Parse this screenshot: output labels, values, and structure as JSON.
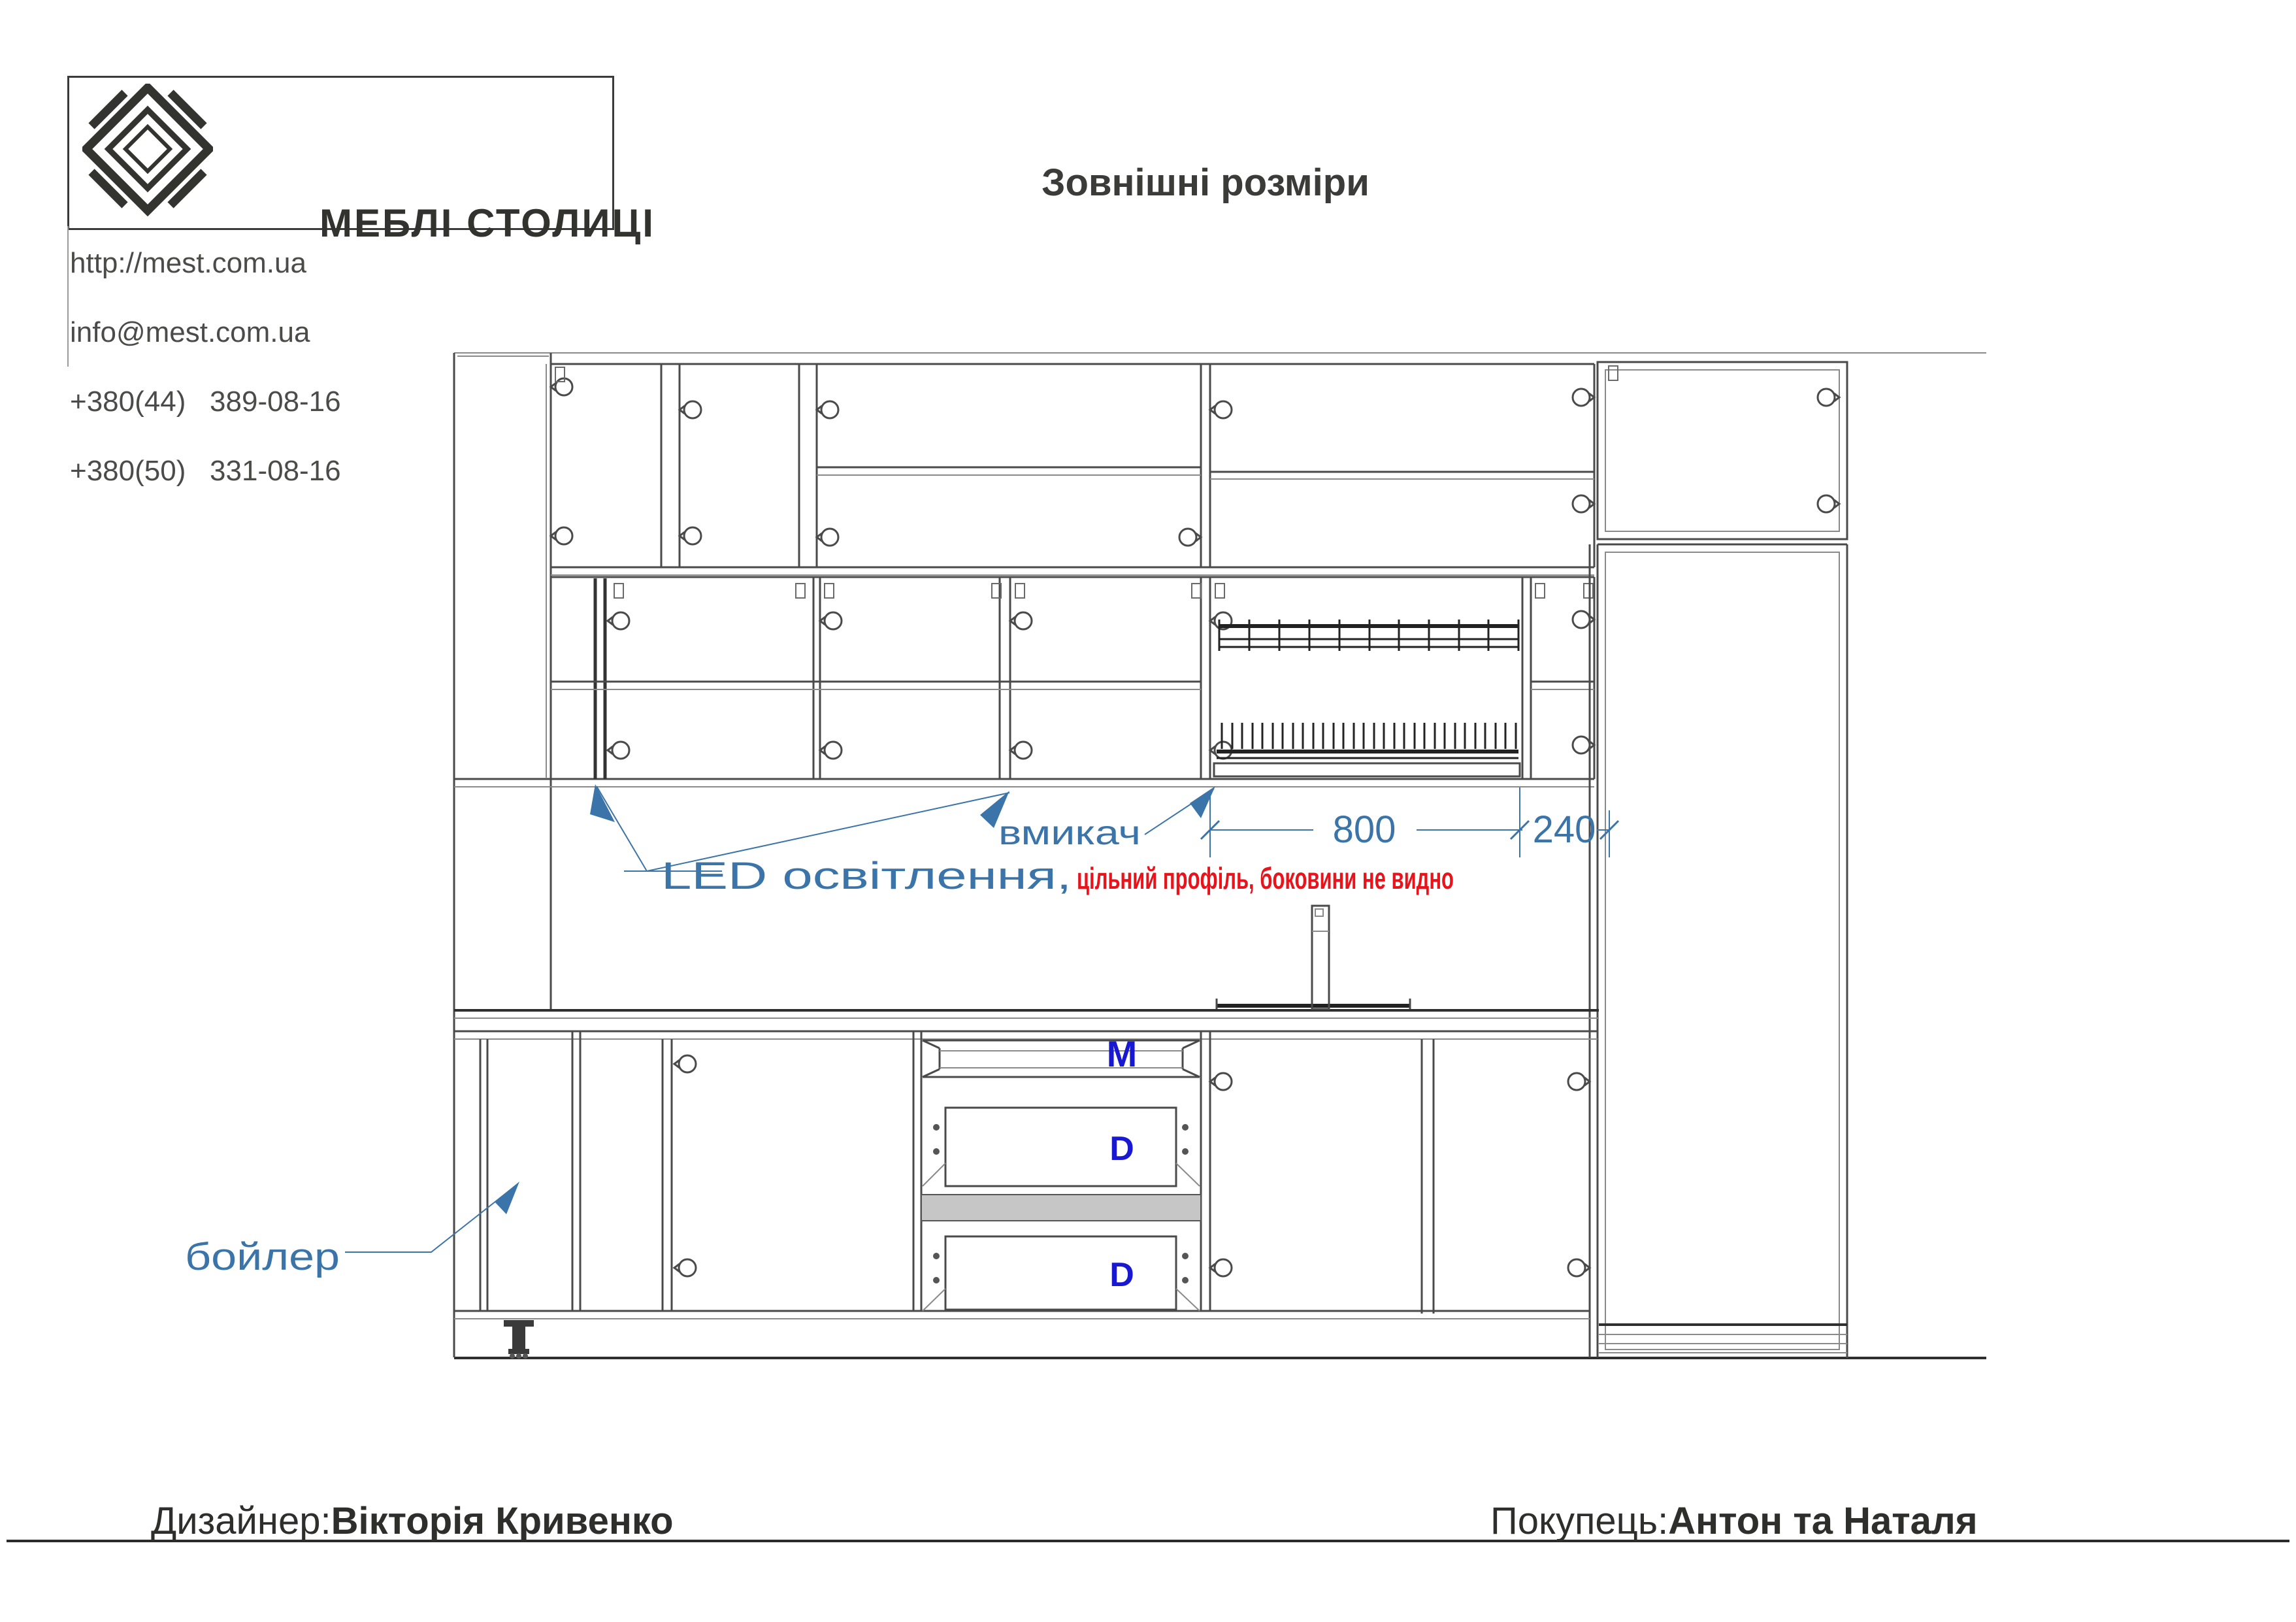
{
  "header": {
    "brand": "МЕБЛІ СТОЛИЦІ",
    "website": "http://mest.com.ua",
    "email": "info@mest.com.ua",
    "phone1": "+380(44)   389-08-16",
    "phone2": "+380(50)   331-08-16",
    "title": "Зовнішні розміри"
  },
  "annotations": {
    "led": "LED освітлення,",
    "note_red": "цільний профіль, боковини не видно",
    "switch": "вмикач",
    "boiler": "бойлер",
    "dim_800": "800",
    "dim_240": "240",
    "drawer_m": "M",
    "drawer_d1": "D",
    "drawer_d2": "D"
  },
  "footer": {
    "designer_label": "Дизайнер:",
    "designer_name": "Вікторія Кривенко",
    "buyer_label": "Покупець:",
    "buyer_name": "Антон та Наталя"
  },
  "colors": {
    "annotation_blue": "#3b74a8",
    "drawer_label_blue": "#1818d2",
    "note_red": "#e9131b",
    "line_dark": "#4a4a4a",
    "line_gray": "#8a8a8a",
    "logo_ink": "#33332f"
  }
}
